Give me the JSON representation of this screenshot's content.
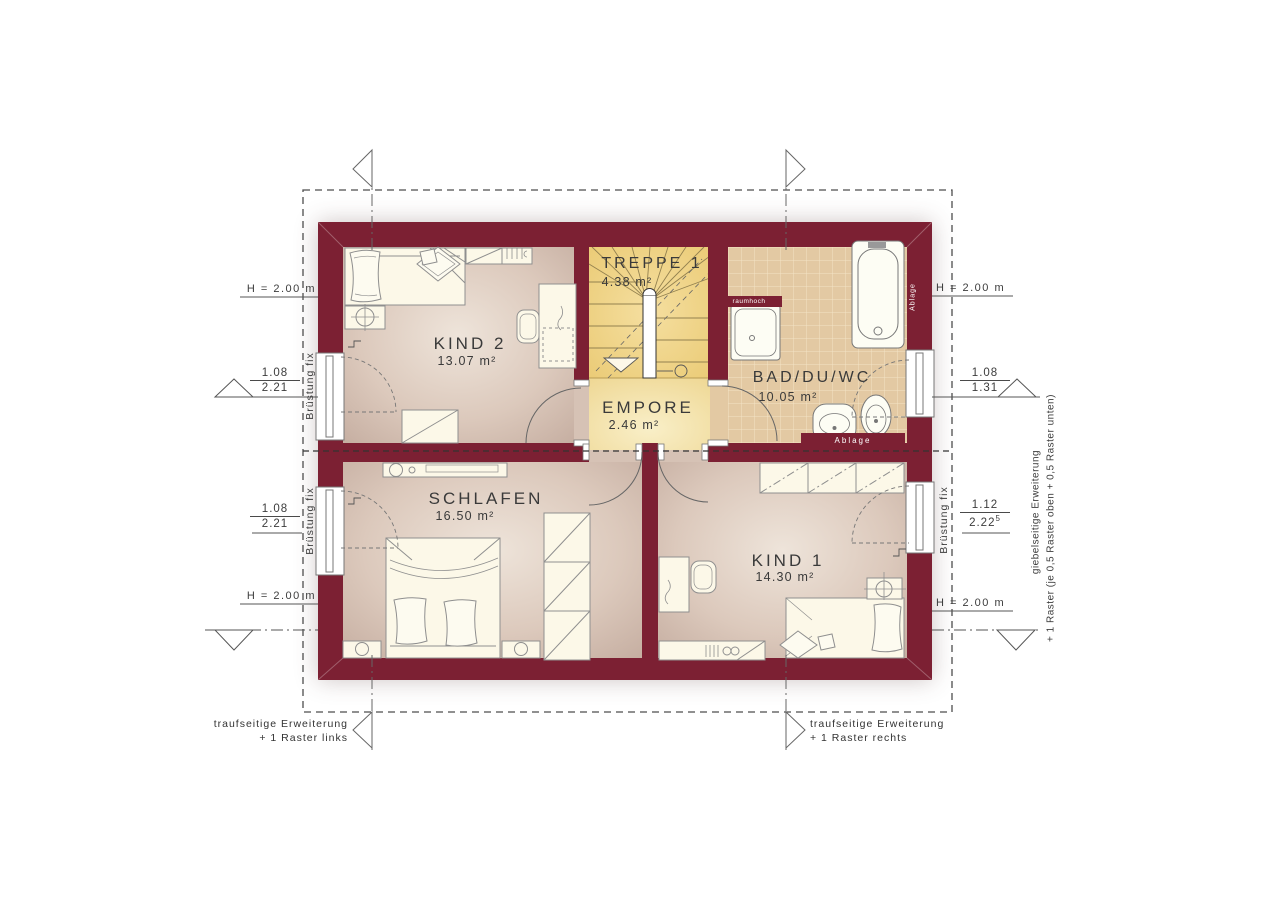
{
  "colors": {
    "wall": "#7c2033",
    "floor_dark": "#c9b2a5",
    "floor_light": "#ece3da",
    "stair_yellow": "#f0d588",
    "empore_yellow": "#f6e7b2",
    "tile": "#e3c9a3",
    "tile_grout": "#f3e4c6",
    "furniture_fill": "#fcf8e8",
    "drawing_line": "#555555"
  },
  "rooms": {
    "kind2": {
      "name": "KIND 2",
      "area": "13.07 m²"
    },
    "treppe": {
      "name": "TREPPE 1",
      "area": "4.38 m²"
    },
    "bad": {
      "name": "BAD/DU/WC",
      "area": "10.05 m²"
    },
    "empore": {
      "name": "EMPORE",
      "area": "2.46 m²"
    },
    "schlafen": {
      "name": "SCHLAFEN",
      "area": "16.50 m²"
    },
    "kind1": {
      "name": "KIND 1",
      "area": "14.30 m²"
    }
  },
  "dimensions": {
    "h_left_top": "H = 2.00 m",
    "h_left_bottom": "H = 2.00 m",
    "h_right_top": "H = 2.00 m",
    "h_right_bottom": "H = 2.00 m",
    "win_left_top": {
      "width": "1.08",
      "sill": "2.21"
    },
    "win_left_bottom": {
      "width": "1.08",
      "sill": "2.21"
    },
    "win_right_top": {
      "width": "1.08",
      "sill": "1.31"
    },
    "win_right_bottom": {
      "width": "1.12",
      "sill": "2.22",
      "sill_sup": "5"
    }
  },
  "wall_labels": {
    "bruestung_fix": "Brüstung fix",
    "raumhoch": "raumhoch",
    "ablage_bottom": "Ablage",
    "ablage_side": "Ablage"
  },
  "annotations": {
    "bottom_left_line1": "traufseitige Erweiterung",
    "bottom_left_line2": "+ 1 Raster links",
    "bottom_right_line1": "traufseitige Erweiterung",
    "bottom_right_line2": "+ 1 Raster rechts",
    "right_line1": "giebelseitige Erweiterung",
    "right_line2": "+ 1 Raster (je 0,5 Raster oben + 0,5 Raster unten)"
  }
}
